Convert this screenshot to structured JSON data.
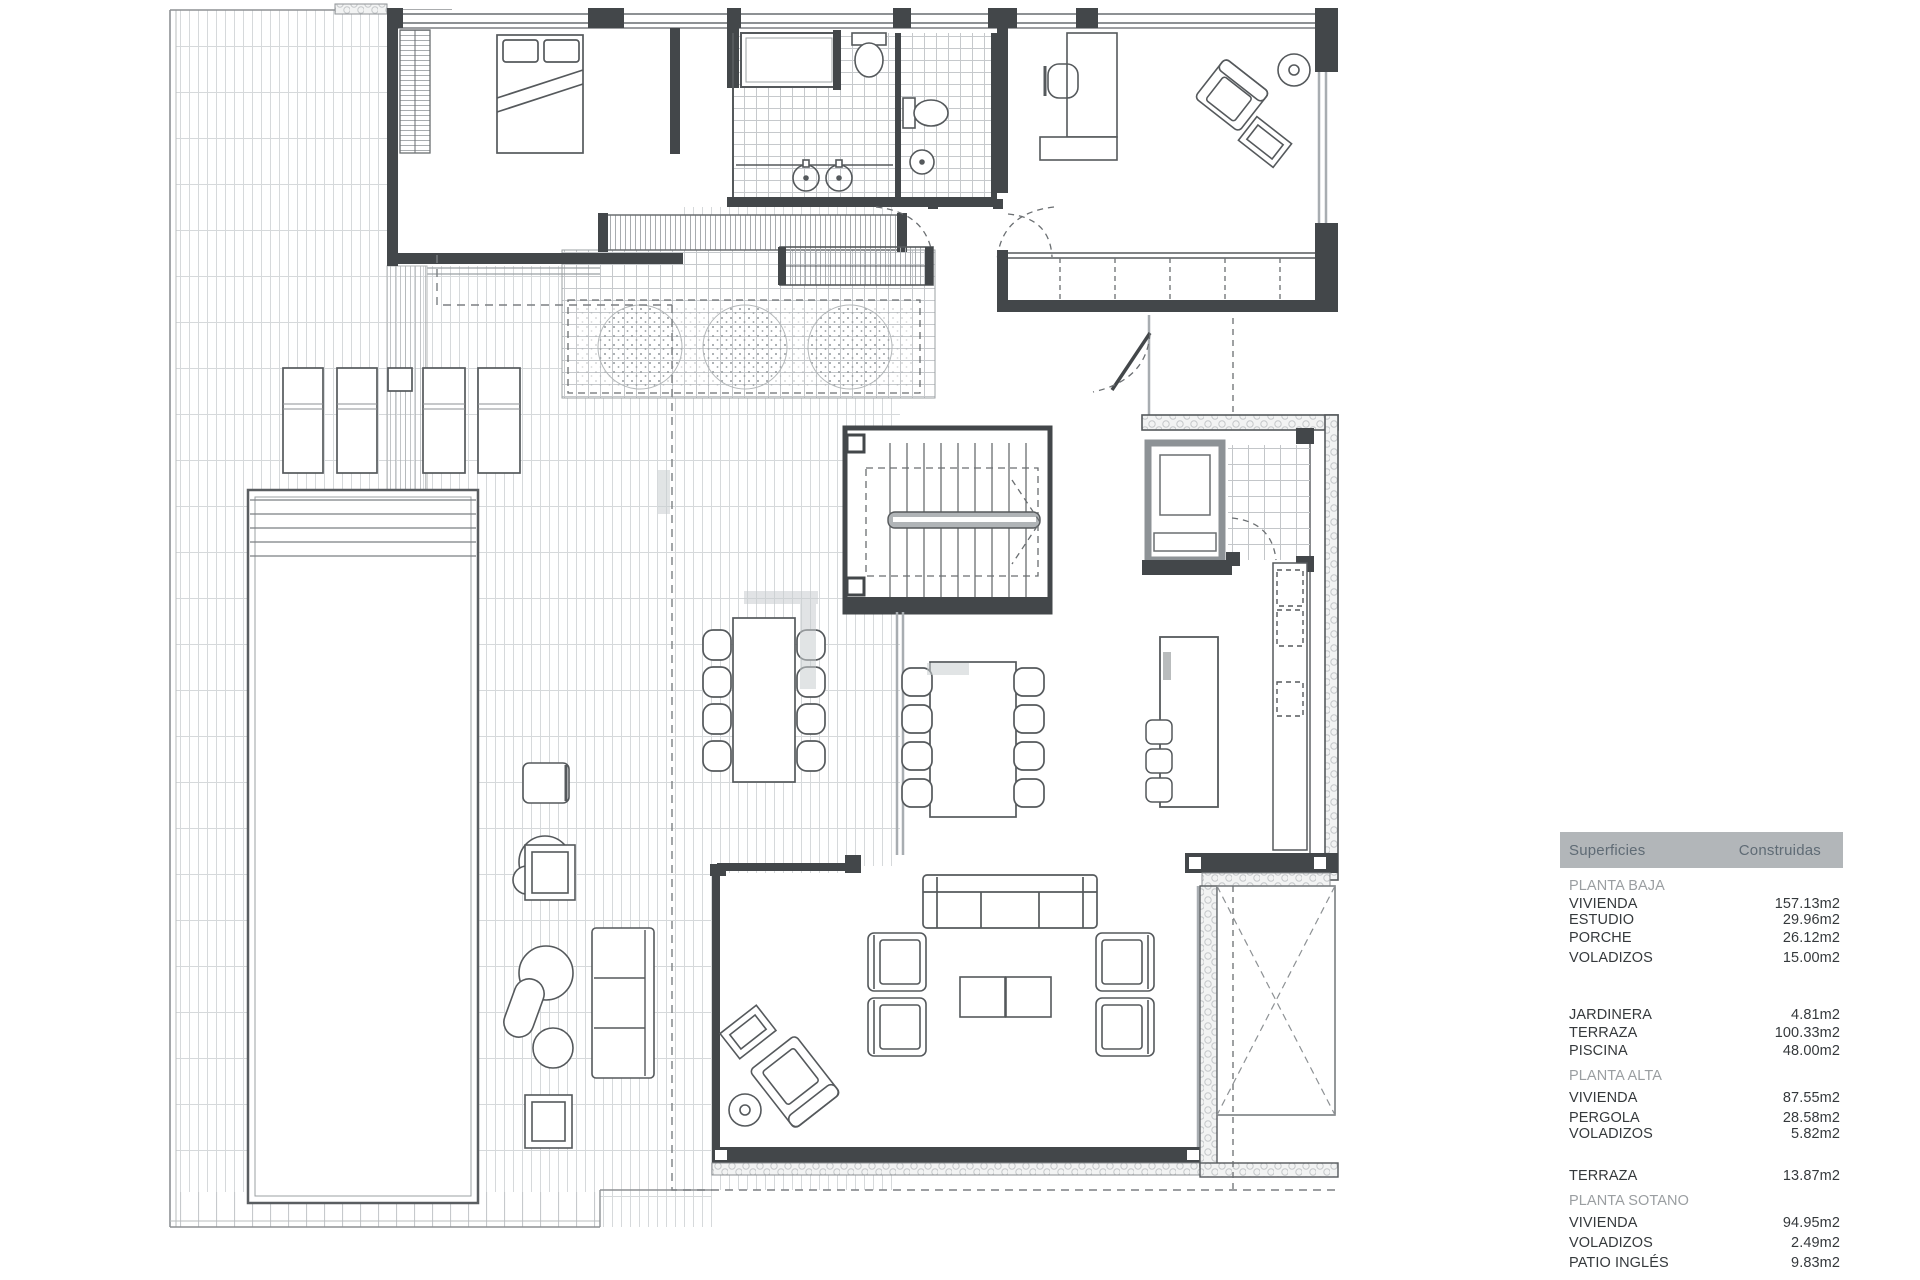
{
  "surfaces_table": {
    "header": {
      "col1": "Superficies",
      "col2": "Construidas",
      "bg": "#b2b6b9",
      "text_color": "#5f6b75"
    },
    "rows": [
      {
        "type": "section",
        "label": "PLANTA BAJA",
        "value": "",
        "mt": 10
      },
      {
        "type": "item",
        "label": "VIVIENDA",
        "value": "157.13m2",
        "mt": 2
      },
      {
        "type": "item",
        "label": "ESTUDIO",
        "value": "29.96m2",
        "mt": 0
      },
      {
        "type": "item",
        "label": "PORCHE",
        "value": "26.12m2",
        "mt": 2
      },
      {
        "type": "item",
        "label": "VOLADIZOS",
        "value": "15.00m2",
        "mt": 4
      },
      {
        "type": "item",
        "label": "JARDINERA",
        "value": "4.81m2",
        "mt": 41
      },
      {
        "type": "item",
        "label": "TERRAZA",
        "value": "100.33m2",
        "mt": 2
      },
      {
        "type": "item",
        "label": "PISCINA",
        "value": "48.00m2",
        "mt": 2
      },
      {
        "type": "section",
        "label": "PLANTA ALTA",
        "value": "",
        "mt": 9
      },
      {
        "type": "item",
        "label": "VIVIENDA",
        "value": "87.55m2",
        "mt": 6
      },
      {
        "type": "item",
        "label": "PERGOLA",
        "value": "28.58m2",
        "mt": 4
      },
      {
        "type": "item",
        "label": "VOLADIZOS",
        "value": "5.82m2",
        "mt": 0
      },
      {
        "type": "item",
        "label": "TERRAZA",
        "value": "13.87m2",
        "mt": 26
      },
      {
        "type": "section",
        "label": "PLANTA SOTANO",
        "value": "",
        "mt": 9
      },
      {
        "type": "item",
        "label": "VIVIENDA",
        "value": "94.95m2",
        "mt": 6
      },
      {
        "type": "item",
        "label": "VOLADIZOS",
        "value": "2.49m2",
        "mt": 4
      },
      {
        "type": "item",
        "label": "PATIO INGLÉS",
        "value": "9.83m2",
        "mt": 4
      }
    ]
  }
}
